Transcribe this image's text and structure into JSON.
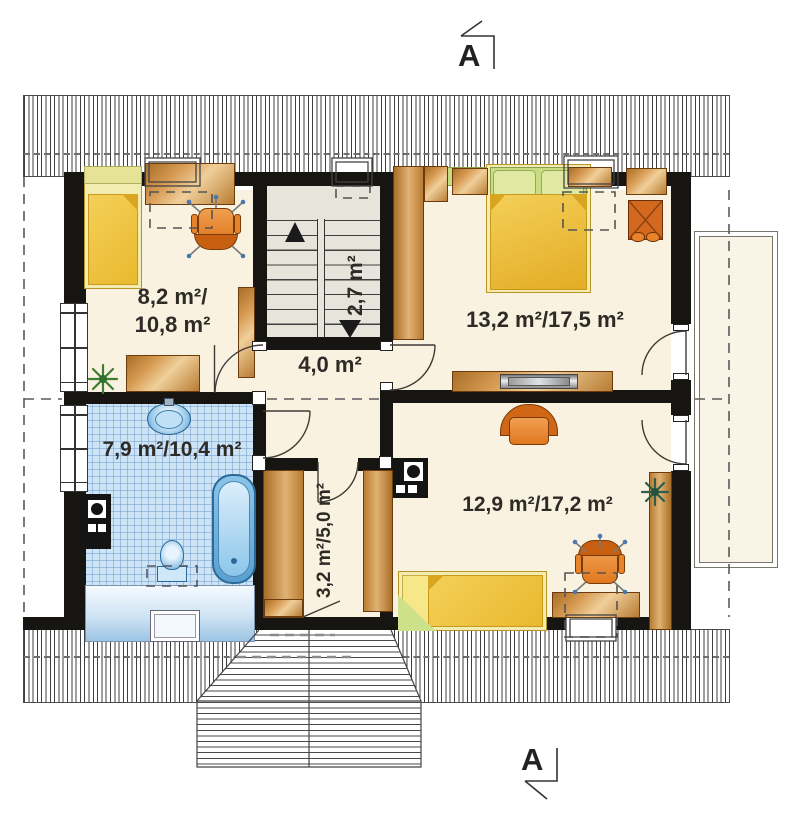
{
  "plan": {
    "type": "attic-floor-plan",
    "section_markers": {
      "top": "A",
      "bottom": "A"
    },
    "rooms": {
      "bedroom_left": {
        "area_line1": "8,2 m²/",
        "area_line2": "10,8 m²"
      },
      "bedroom_right": {
        "area": "13,2 m²/17,5 m²"
      },
      "bathroom": {
        "area": "7,9 m²/10,4 m²"
      },
      "hall": {
        "area": "4,0 m²"
      },
      "stairs": {
        "area": "2,7 m²"
      },
      "wardrobe_room": {
        "area": "3,2 m²/5,0 m²"
      },
      "bedroom_bottom": {
        "area": "12,9 m²/17,2 m²"
      }
    },
    "colors": {
      "wall": "#171512",
      "floor_cream": "#faf2e0",
      "stair_gray": "#e7e4db",
      "bath_tile_blue": "#cde4f6",
      "wood": "#c98539",
      "bed_yellow": "#f0c545",
      "bed_pale": "#f2ecb0",
      "headboard_green": "#c9dc84",
      "chair_orange": "#e07820",
      "fixture_blue": "#5fa8d8"
    }
  }
}
